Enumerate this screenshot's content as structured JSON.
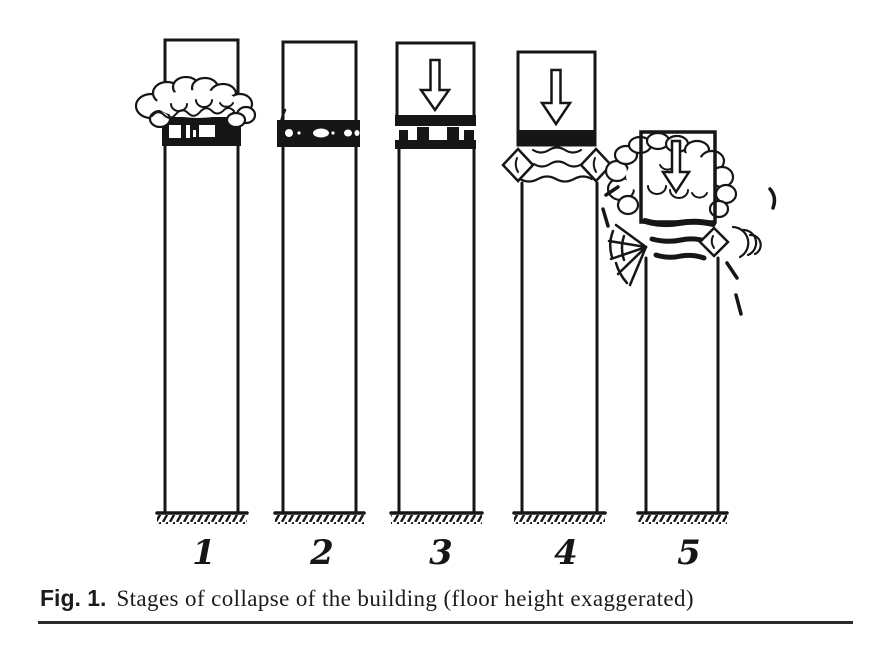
{
  "figure": {
    "caption": {
      "label": "Fig. 1.",
      "text": "Stages of collapse of the building (floor height exaggerated)"
    },
    "stages": [
      {
        "number": "1"
      },
      {
        "number": "2"
      },
      {
        "number": "3"
      },
      {
        "number": "4"
      },
      {
        "number": "5"
      }
    ]
  },
  "colors": {
    "ink": "#161616",
    "background": "#ffffff"
  }
}
